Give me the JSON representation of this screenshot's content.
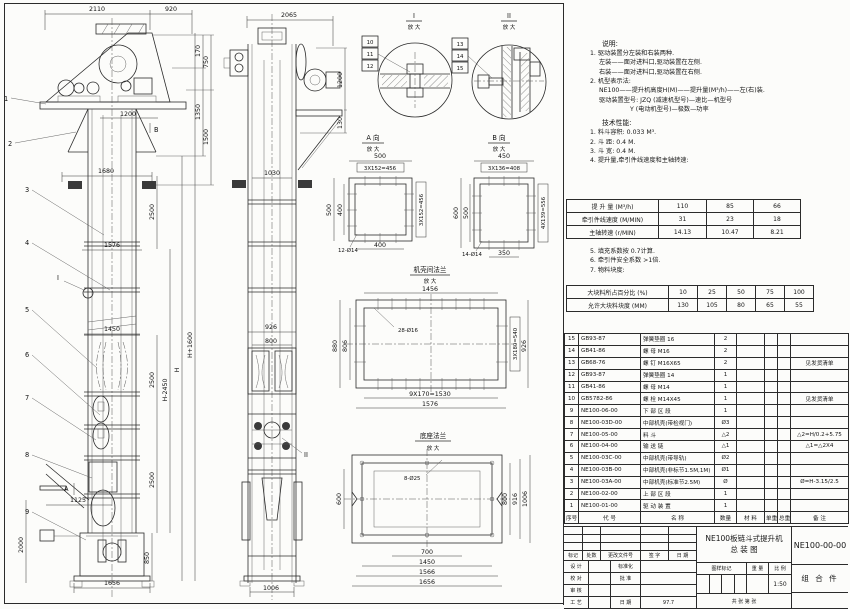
{
  "views": {
    "front": {
      "balloons": [
        "1",
        "2",
        "3",
        "4",
        "5",
        "6",
        "7",
        "8",
        "9"
      ],
      "marker_a": "A",
      "marker_b": "B",
      "marker_i": "I",
      "dims": {
        "d2110": "2110",
        "d920": "920",
        "d170": "170",
        "d750": "750",
        "d1350": "1350",
        "d1500": "1500",
        "d1200": "1200",
        "d1680": "1680",
        "d2500a": "2500",
        "d1576": "1576",
        "dHp": "H+1600",
        "dHm": "H-2450",
        "dH": "H",
        "d1450": "1450",
        "d2500b": "2500",
        "d2500c": "2500",
        "d1125": "1125",
        "d2000": "2000",
        "d850": "850",
        "d1656": "1656"
      }
    },
    "side": {
      "marker_ii": "II",
      "dims": {
        "d2065": "2065",
        "d1200": "1200",
        "d130": "130",
        "d1030": "1030",
        "d926": "926",
        "d800": "800",
        "d1006": "1006"
      }
    },
    "detail1": {
      "title": "I",
      "sub": "放 大",
      "balloons": [
        "10",
        "11",
        "12"
      ]
    },
    "detail2": {
      "title": "II",
      "sub": "放 大",
      "balloons": [
        "13",
        "14",
        "15"
      ]
    },
    "viewA": {
      "title": "A 向",
      "sub": "放 大",
      "dims": {
        "top": "500",
        "top2": "3X152=456",
        "left": "500",
        "left2": "400",
        "right": "3X152=456",
        "bottom": "400",
        "holes": "12-Ø14"
      }
    },
    "viewB": {
      "title": "B 向",
      "sub": "放 大",
      "dims": {
        "top": "450",
        "top2": "3X136=408",
        "left": "600",
        "left2": "500",
        "right": "4X139=556",
        "bottom": "350",
        "holes": "14-Ø14"
      }
    },
    "flangeMid": {
      "title": "机壳间法兰",
      "sub": "放 大",
      "dims": {
        "top": "1456",
        "holes": "28-Ø16",
        "left": "880",
        "left2": "806",
        "right": "3X180=540",
        "right2": "926",
        "bottom": "9X170=1530",
        "bottom2": "1576"
      }
    },
    "flangeBase": {
      "title": "底座法兰",
      "sub": "放 大",
      "dims": {
        "holes": "8-Ø25",
        "left": "600",
        "right1": "800",
        "right2": "916",
        "right3": "1006",
        "bottom1": "700",
        "bottom2": "1450",
        "bottom3": "1566",
        "bottom4": "1656"
      }
    }
  },
  "notes": {
    "title": "说明:",
    "lines": [
      "1. 驱动装置分左装和右装两种.",
      "左装——面对进料口,驱动装置在左侧.",
      "右装——面对进料口,驱动装置在右侧.",
      "2. 机型表示法:",
      "NE100——提升机高度H(M)——提升量(M³/h)——左(右)装.",
      "驱动装置型号: JZQ (减速机型号)—速比—机型号",
      "Y (电动机型号)—极数—功率"
    ]
  },
  "tech": {
    "title": "技术性能:",
    "items_pre": [
      "1. 料斗容积: 0.033 M³.",
      "2. 斗   距: 0.4 M.",
      "3. 斗   宽: 0.4 M.",
      "4. 提升量,牵引件线速度和主轴转速:"
    ],
    "speed_table": {
      "rows": [
        {
          "label": "提 升 量  (M³/h)",
          "values": [
            "110",
            "85",
            "66"
          ]
        },
        {
          "label": "牵引件线速度 (M/MIN)",
          "values": [
            "31",
            "23",
            "18"
          ]
        },
        {
          "label": "主轴转速 (r/MIN)",
          "values": [
            "14.13",
            "10.47",
            "8.21"
          ]
        }
      ]
    },
    "items_mid": [
      "5. 填充系数按 0.7计算.",
      "6. 牵引件安全系数 >1倍.",
      "7. 物料块度:"
    ],
    "lump_table": {
      "rows": [
        {
          "label": "大块料所占百分比 (%)",
          "values": [
            "10",
            "25",
            "50",
            "75",
            "100"
          ]
        },
        {
          "label": "允许大块料块度 (MM)",
          "values": [
            "130",
            "105",
            "80",
            "65",
            "55"
          ]
        }
      ]
    }
  },
  "bom": {
    "header": [
      "序号",
      "代  号",
      "名  称",
      "数量",
      "材  料",
      "单重",
      "总重",
      "备  注"
    ],
    "rows": [
      {
        "no": "15",
        "code": "GB93-87",
        "name": "弹簧垫圈 16",
        "qty": "2",
        "remark": ""
      },
      {
        "no": "14",
        "code": "GB41-86",
        "name": "螺 母  M16",
        "qty": "2",
        "remark": ""
      },
      {
        "no": "13",
        "code": "GB68-76",
        "name": "螺 钉  M16X65",
        "qty": "2",
        "remark": "见发货清单"
      },
      {
        "no": "12",
        "code": "GB93-87",
        "name": "弹簧垫圈 14",
        "qty": "1",
        "remark": ""
      },
      {
        "no": "11",
        "code": "GB41-86",
        "name": "螺 母  M14",
        "qty": "1",
        "remark": ""
      },
      {
        "no": "10",
        "code": "GB5782-86",
        "name": "螺 栓  M14X45",
        "qty": "1",
        "remark": "见发货清单"
      },
      {
        "no": "9",
        "code": "NE100-06-00",
        "name": "下 部 区 段",
        "qty": "1",
        "remark": ""
      },
      {
        "no": "8",
        "code": "NE100-03D-00",
        "name": "中部机壳(带检视门)",
        "qty": "Ø3",
        "remark": ""
      },
      {
        "no": "7",
        "code": "NE100-05-00",
        "name": "料 斗",
        "qty": "△2",
        "remark": "△2=H/0.2+5.75"
      },
      {
        "no": "6",
        "code": "NE100-04-00",
        "name": "输 送 链",
        "qty": "△1",
        "remark": "△1=△2X4"
      },
      {
        "no": "5",
        "code": "NE100-03C-00",
        "name": "中部机壳(带导轨)",
        "qty": "Ø2",
        "remark": ""
      },
      {
        "no": "4",
        "code": "NE100-03B-00",
        "name": "中部机壳(非标节1.5M,1M)",
        "qty": "Ø1",
        "remark": ""
      },
      {
        "no": "3",
        "code": "NE100-03A-00",
        "name": "中部机壳(标准节2.5M)",
        "qty": "Ø",
        "remark": "Ø=H-3.15/2.5"
      },
      {
        "no": "2",
        "code": "NE100-02-00",
        "name": "上 部 区 段",
        "qty": "1",
        "remark": ""
      },
      {
        "no": "1",
        "code": "NE100-01-00",
        "name": "驱 动 装 置",
        "qty": "1",
        "remark": ""
      }
    ]
  },
  "title_block": {
    "product_title_1": "NE100板链斗式提升机",
    "product_title_2": "总  装  图",
    "drawing_no": "NE100-00-00",
    "part_category": "组 合 件",
    "rev_row": [
      "标记",
      "处数",
      "更改文件号",
      "签 字",
      "日 期"
    ],
    "roles": [
      [
        "设 计",
        "标准化",
        ""
      ],
      [
        "校 对",
        "批 准",
        ""
      ],
      [
        "审 核",
        "",
        ""
      ],
      [
        "工 艺",
        "日 期",
        "97.7"
      ]
    ],
    "stamp_labels": [
      "图样标记",
      "重 量",
      "比 例"
    ],
    "scale": "1:50",
    "sheet_info": "共   张  第   张"
  }
}
